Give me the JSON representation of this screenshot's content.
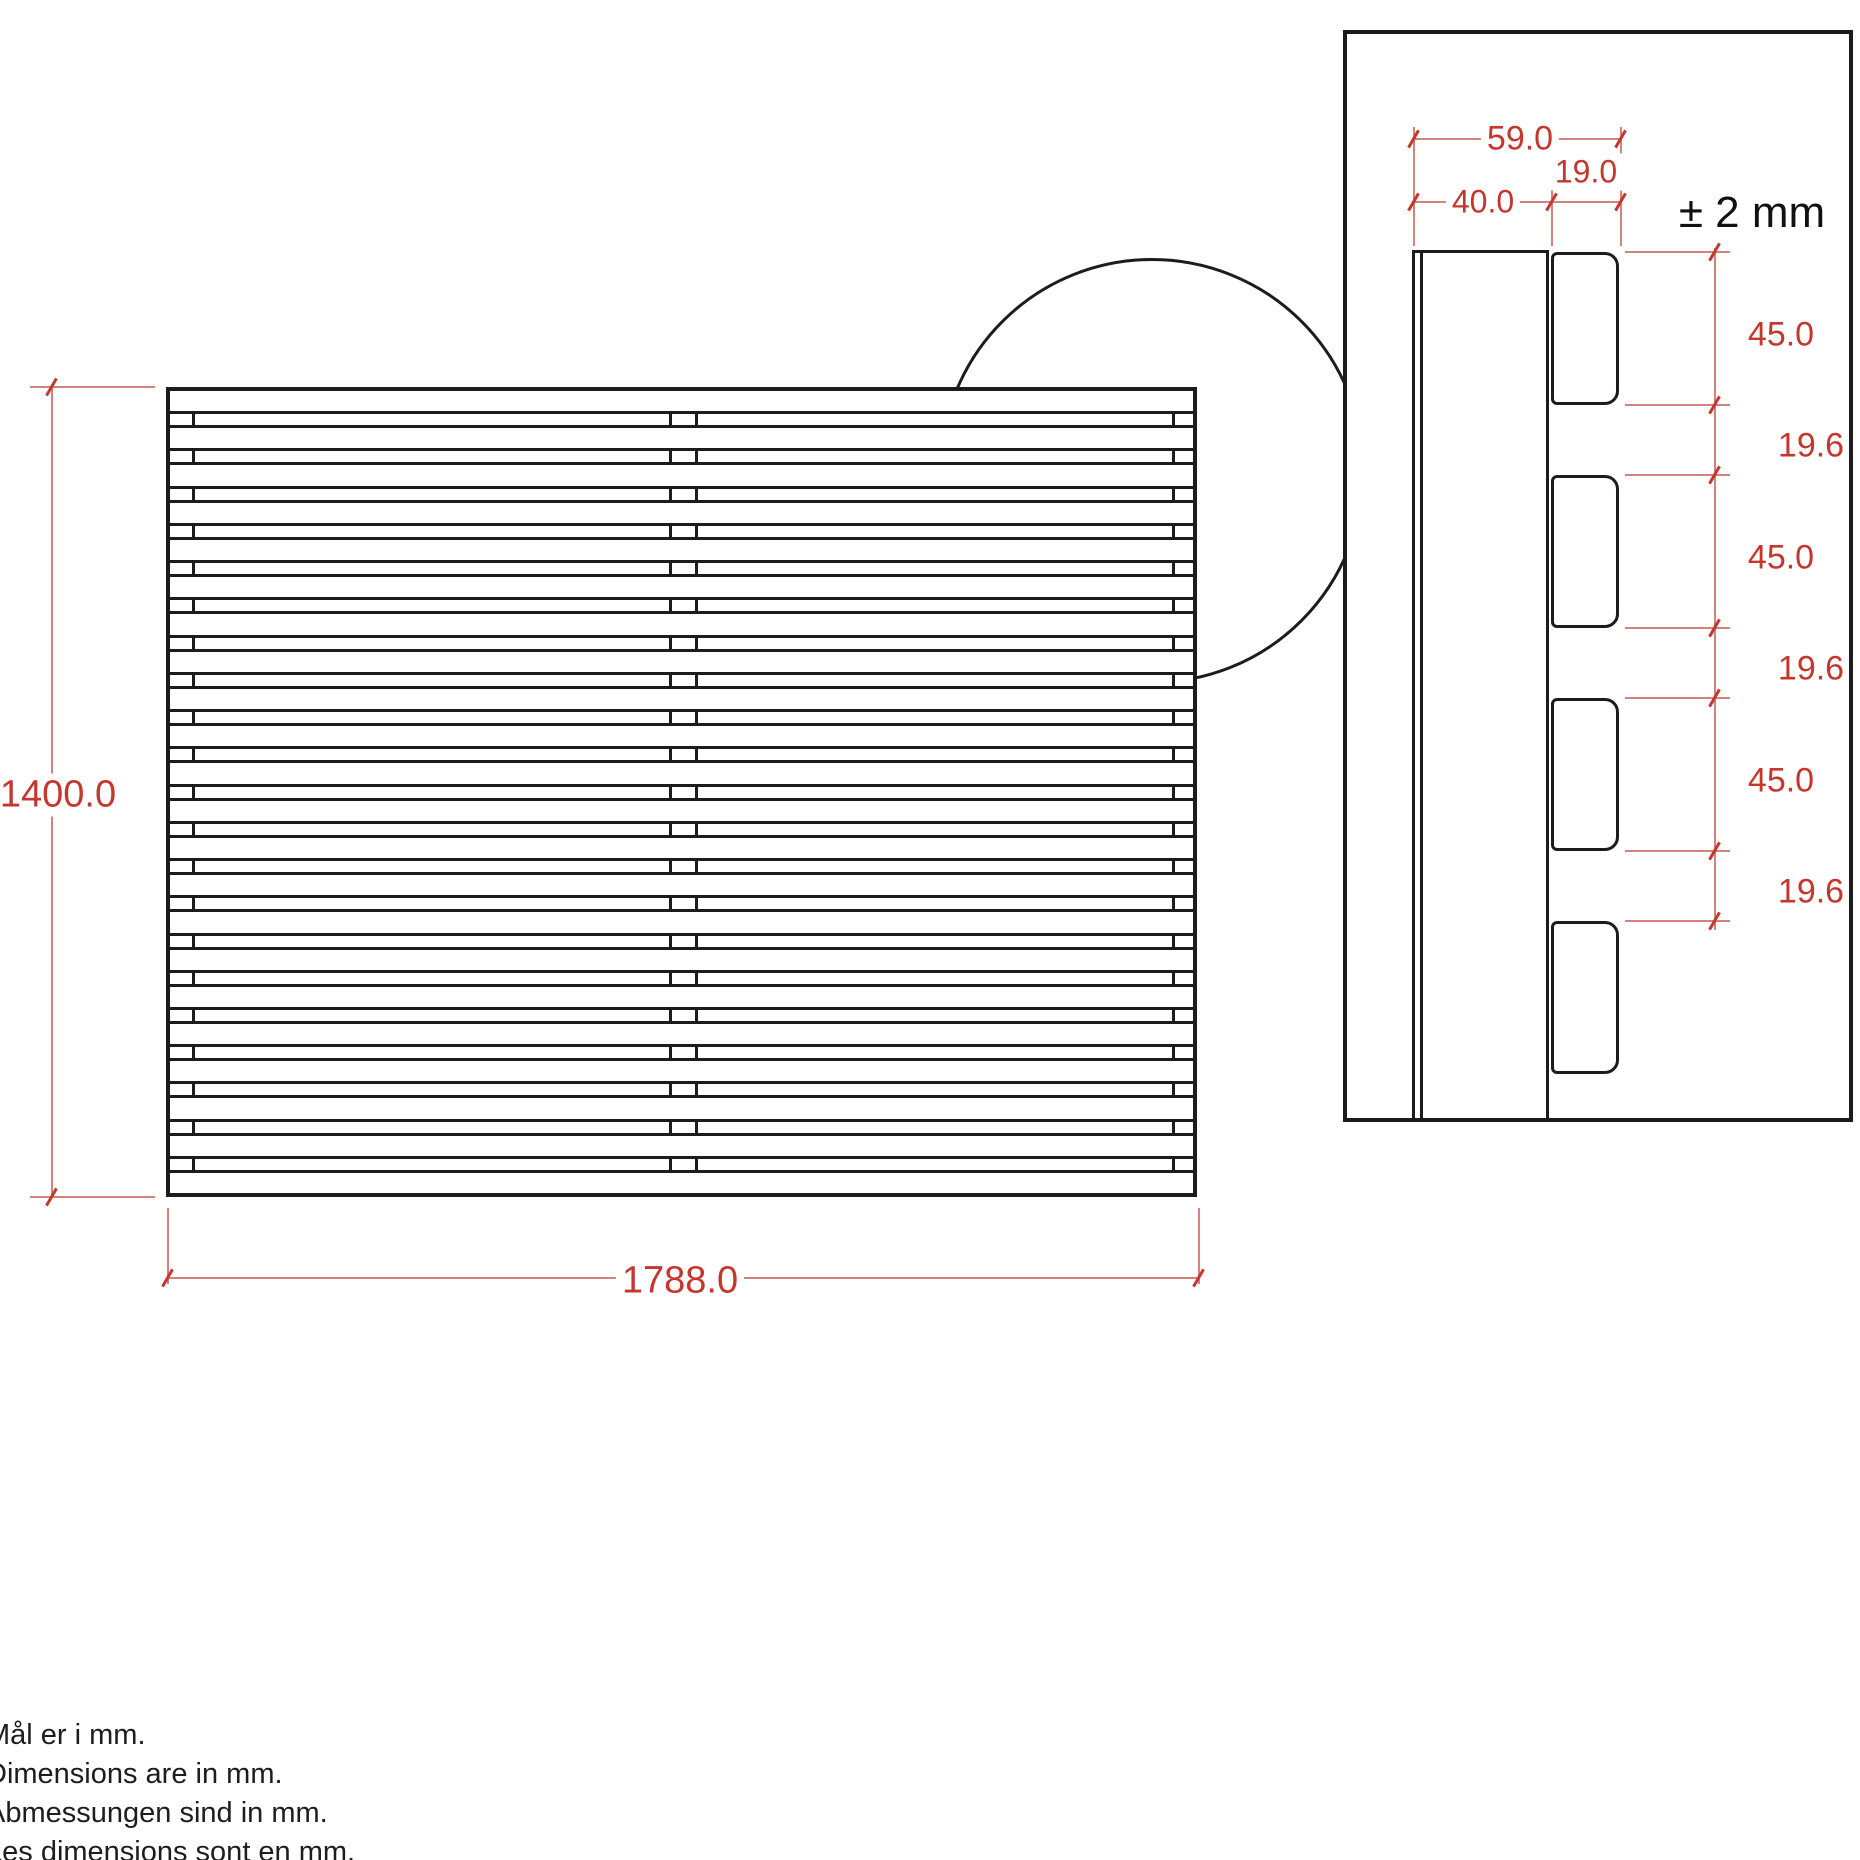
{
  "front_view": {
    "height_label": "1400.0",
    "width_label": "1788.0",
    "slat_count": 22
  },
  "detail_view": {
    "depth_total_label": "59.0",
    "depth_batten_label": "40.0",
    "depth_slat_label": "19.0",
    "tolerance_label": "± 2 mm",
    "side_dims": [
      "45.0",
      "19.6",
      "45.0",
      "19.6",
      "45.0",
      "19.6"
    ],
    "slat_block_count": 4
  },
  "notes": [
    "Mål er i mm.",
    "Dimensions are in mm.",
    "Abmessungen sind in mm.",
    "Les dimensions sont en mm."
  ],
  "colors": {
    "dimension_red": "#c5372d",
    "dimension_red_line": "#d4837c",
    "line_black": "#1c1c1c"
  }
}
